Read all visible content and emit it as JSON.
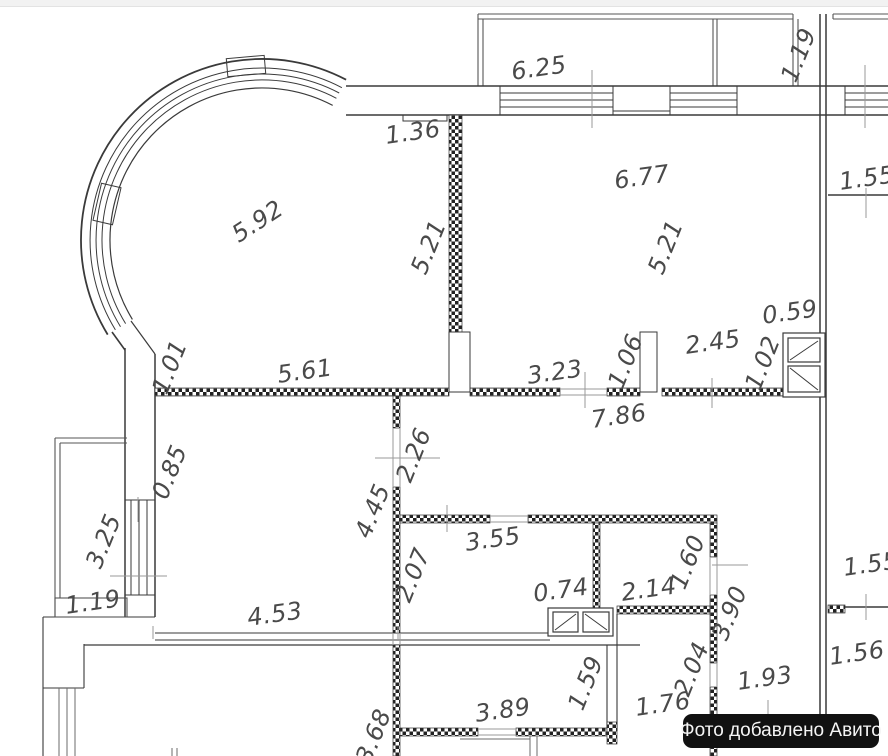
{
  "watermark": {
    "text": "Фото добавлено Авито"
  },
  "colors": {
    "background": "#ffffff",
    "wall_line": "#3a3a3a",
    "thin_line": "#9a9a9a",
    "label_text": "#4a4a4a",
    "watermark_bg": "#111111",
    "watermark_text": "#f5f5f5"
  },
  "labels": [
    {
      "text": "5.92",
      "x": 262,
      "y": 228,
      "r": -33
    },
    {
      "text": "1.36",
      "x": 414,
      "y": 140,
      "r": -8
    },
    {
      "text": "6.25",
      "x": 540,
      "y": 76,
      "r": -8
    },
    {
      "text": "1.19",
      "x": 806,
      "y": 58,
      "r": -68
    },
    {
      "text": "6.77",
      "x": 643,
      "y": 185,
      "r": -8
    },
    {
      "text": "1.55",
      "x": 868,
      "y": 186,
      "r": -8
    },
    {
      "text": "5.21",
      "x": 436,
      "y": 250,
      "r": -68
    },
    {
      "text": "5.21",
      "x": 673,
      "y": 250,
      "r": -68
    },
    {
      "text": "0.59",
      "x": 791,
      "y": 320,
      "r": -8
    },
    {
      "text": "2.45",
      "x": 714,
      "y": 350,
      "r": -8
    },
    {
      "text": "1.06",
      "x": 633,
      "y": 364,
      "r": -68
    },
    {
      "text": "1.02",
      "x": 770,
      "y": 366,
      "r": -68
    },
    {
      "text": "1.01",
      "x": 177,
      "y": 370,
      "r": -68
    },
    {
      "text": "5.61",
      "x": 306,
      "y": 379,
      "r": -8
    },
    {
      "text": "3.23",
      "x": 556,
      "y": 380,
      "r": -8
    },
    {
      "text": "7.86",
      "x": 620,
      "y": 424,
      "r": -8
    },
    {
      "text": "2.26",
      "x": 421,
      "y": 458,
      "r": -68
    },
    {
      "text": "0.85",
      "x": 177,
      "y": 475,
      "r": -68
    },
    {
      "text": "4.45",
      "x": 380,
      "y": 514,
      "r": -68
    },
    {
      "text": "3.25",
      "x": 111,
      "y": 544,
      "r": -68
    },
    {
      "text": "3.55",
      "x": 494,
      "y": 547,
      "r": -8
    },
    {
      "text": "2.07",
      "x": 420,
      "y": 578,
      "r": -68
    },
    {
      "text": "1.60",
      "x": 695,
      "y": 565,
      "r": -68
    },
    {
      "text": "1.19",
      "x": 94,
      "y": 610,
      "r": -8
    },
    {
      "text": "0.74",
      "x": 562,
      "y": 598,
      "r": -8
    },
    {
      "text": "2.14",
      "x": 650,
      "y": 597,
      "r": -8
    },
    {
      "text": "1.55",
      "x": 872,
      "y": 572,
      "r": -8
    },
    {
      "text": "3.90",
      "x": 737,
      "y": 616,
      "r": -68
    },
    {
      "text": "4.53",
      "x": 276,
      "y": 622,
      "r": -8
    },
    {
      "text": "1.56",
      "x": 858,
      "y": 661,
      "r": -8
    },
    {
      "text": "2.04",
      "x": 699,
      "y": 672,
      "r": -68
    },
    {
      "text": "1.93",
      "x": 766,
      "y": 686,
      "r": -8
    },
    {
      "text": "1.76",
      "x": 664,
      "y": 712,
      "r": -8
    },
    {
      "text": "1.59",
      "x": 593,
      "y": 686,
      "r": -68
    },
    {
      "text": "3.89",
      "x": 504,
      "y": 718,
      "r": -8
    },
    {
      "text": "3.68",
      "x": 381,
      "y": 739,
      "r": -68
    }
  ]
}
